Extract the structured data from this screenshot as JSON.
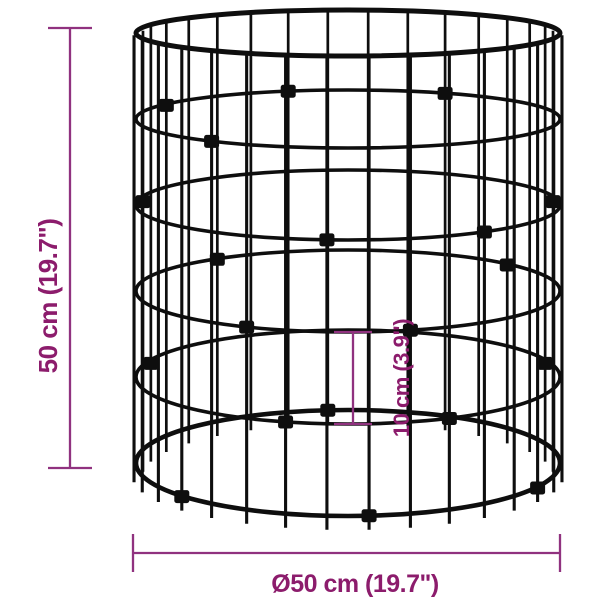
{
  "page": {
    "background": "#ffffff"
  },
  "diagram": {
    "product_name": "cylindrical-wire-gabion-basket",
    "colors": {
      "wire": "#0e0e0e",
      "dimension_line": "#90327f",
      "dimension_text": "#8c1c6c",
      "background": "#ffffff"
    },
    "dimensions": {
      "height": {
        "label": "50 cm (19.7\")",
        "value_cm": 50,
        "value_in": 19.7
      },
      "diameter": {
        "label": "Ø50 cm (19.7\")",
        "value_cm": 50,
        "value_in": 19.7
      },
      "mesh": {
        "label": "10 cm (3.9\")",
        "value_cm": 10,
        "value_in": 3.9
      }
    }
  }
}
